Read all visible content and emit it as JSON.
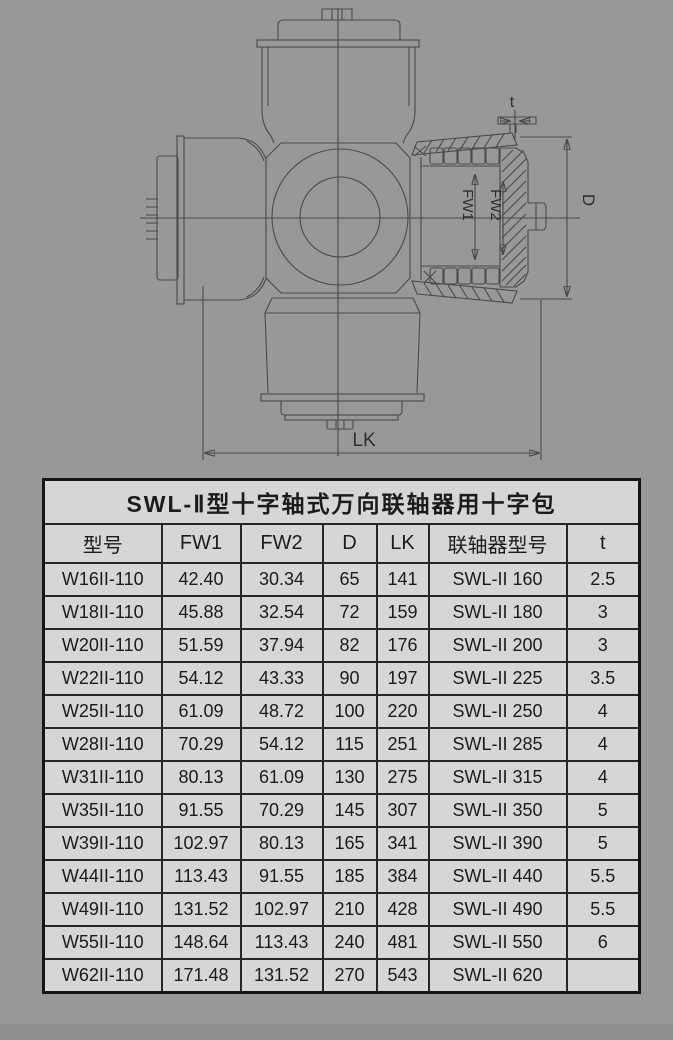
{
  "page": {
    "background": "#989898",
    "table_background": "#d6d6d6",
    "bottom_strip_color": "#8d8d8d",
    "drawing_line_color": "#4a4a4a"
  },
  "diagram": {
    "labels": {
      "t": "t",
      "D": "D",
      "LK": "LK",
      "FW1": "FW1",
      "FW2": "FW2"
    }
  },
  "table": {
    "title": "SWL-Ⅱ型十字轴式万向联轴器用十字包",
    "columns": [
      "型号",
      "FW1",
      "FW2",
      "D",
      "LK",
      "联轴器型号",
      "t"
    ],
    "rows": [
      [
        "W16II-110",
        "42.40",
        "30.34",
        "65",
        "141",
        "SWL-II 160",
        "2.5"
      ],
      [
        "W18II-110",
        "45.88",
        "32.54",
        "72",
        "159",
        "SWL-II 180",
        "3"
      ],
      [
        "W20II-110",
        "51.59",
        "37.94",
        "82",
        "176",
        "SWL-II 200",
        "3"
      ],
      [
        "W22II-110",
        "54.12",
        "43.33",
        "90",
        "197",
        "SWL-II 225",
        "3.5"
      ],
      [
        "W25II-110",
        "61.09",
        "48.72",
        "100",
        "220",
        "SWL-II 250",
        "4"
      ],
      [
        "W28II-110",
        "70.29",
        "54.12",
        "115",
        "251",
        "SWL-II 285",
        "4"
      ],
      [
        "W31II-110",
        "80.13",
        "61.09",
        "130",
        "275",
        "SWL-II 315",
        "4"
      ],
      [
        "W35II-110",
        "91.55",
        "70.29",
        "145",
        "307",
        "SWL-II 350",
        "5"
      ],
      [
        "W39II-110",
        "102.97",
        "80.13",
        "165",
        "341",
        "SWL-II 390",
        "5"
      ],
      [
        "W44II-110",
        "113.43",
        "91.55",
        "185",
        "384",
        "SWL-II 440",
        "5.5"
      ],
      [
        "W49II-110",
        "131.52",
        "102.97",
        "210",
        "428",
        "SWL-II 490",
        "5.5"
      ],
      [
        "W55II-110",
        "148.64",
        "113.43",
        "240",
        "481",
        "SWL-II 550",
        "6"
      ],
      [
        "W62II-110",
        "171.48",
        "131.52",
        "270",
        "543",
        "SWL-II 620",
        ""
      ]
    ]
  }
}
